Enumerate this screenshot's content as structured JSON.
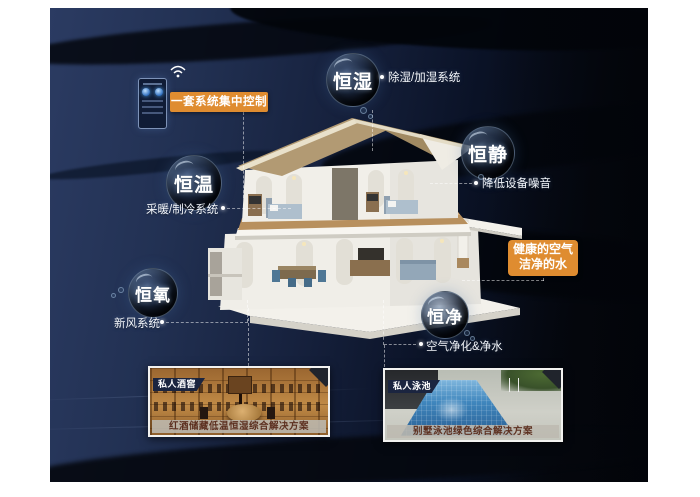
{
  "control_panel": {
    "label": "一套系统集中控制"
  },
  "bubbles": [
    {
      "id": "constant-humidity",
      "label": "恒湿",
      "note": "除湿/加湿系统"
    },
    {
      "id": "constant-quiet",
      "label": "恒静",
      "note": "降低设备噪音"
    },
    {
      "id": "constant-temperature",
      "label": "恒温",
      "note": "采暖/制冷系统"
    },
    {
      "id": "constant-oxygen",
      "label": "恒氧",
      "note": "新风系统"
    },
    {
      "id": "constant-purity",
      "label": "恒净",
      "note": "空气净化&净水"
    }
  ],
  "highlight_box": {
    "line1": "健康的空气",
    "line2": "洁净的水"
  },
  "cards": [
    {
      "id": "wine-cellar",
      "badge": "私人酒窖",
      "caption": "红酒储藏低温恒湿综合解决方案"
    },
    {
      "id": "pool",
      "badge": "私人泳池",
      "caption": "别墅泳池绿色综合解决方案"
    }
  ],
  "icons": {
    "wifi": "wifi-icon"
  },
  "colors": {
    "accent_orange": "#DF8C30",
    "background_navy": "#223153",
    "background_black": "#04060C",
    "badge_navy": "#1B2540",
    "caption_band_gray": "#BDB9B1",
    "caption_text_brown": "#5C2F1F",
    "roof_tan": "#B29A73"
  }
}
